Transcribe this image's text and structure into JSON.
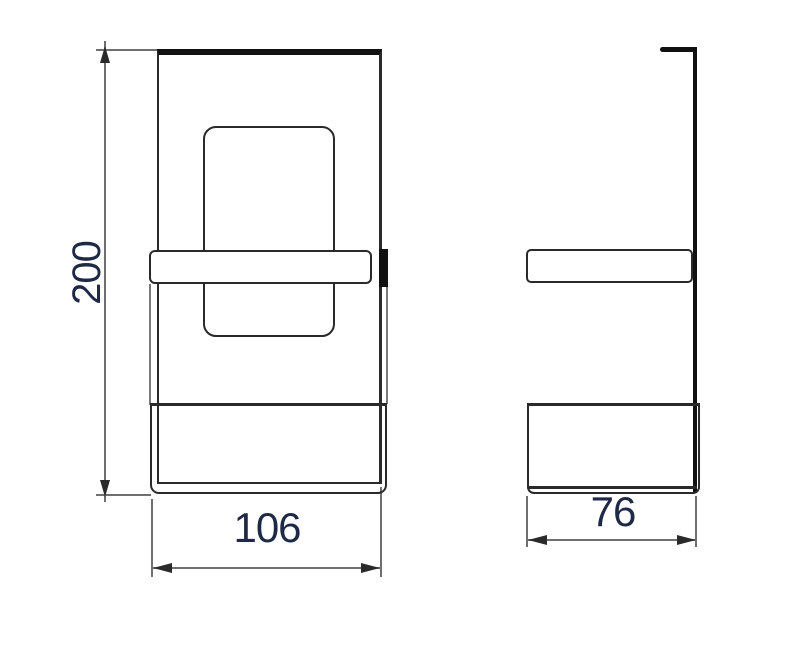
{
  "drawing": {
    "title": "bracket-two-view-technical-drawing",
    "views": [
      {
        "id": "front",
        "label": "front-view"
      },
      {
        "id": "side",
        "label": "side-view"
      }
    ],
    "dimensions": {
      "height": {
        "value": "200"
      },
      "width": {
        "value": "106"
      },
      "depth": {
        "value": "76"
      }
    },
    "colors": {
      "line": "#2a2a2a",
      "thick": "#111111",
      "dim_line": "#6f6f6f",
      "flange": "#7a7a7a",
      "dim_text": "#1e2a45",
      "background": "#ffffff"
    }
  }
}
